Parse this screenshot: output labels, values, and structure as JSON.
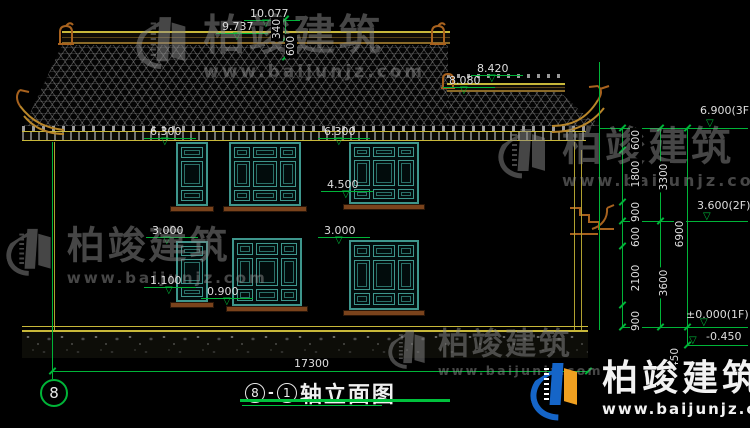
{
  "title_block": {
    "axis_left_bubble": "8",
    "circle_a": "8",
    "dash": "-",
    "circle_b": "1",
    "name": "轴立面图",
    "overall_dim": "17300"
  },
  "icons": {
    "level_triangle": "▽"
  },
  "levels": [
    {
      "t": "10.077",
      "x": 250,
      "y": 8,
      "lx": 244,
      "lw": 56,
      "tx": 262
    },
    {
      "t": "9.737",
      "x": 222,
      "y": 21,
      "lx": 216,
      "lw": 52,
      "tx": 233
    },
    {
      "t": "8.420",
      "x": 477,
      "y": 63,
      "lx": 471,
      "lw": 52,
      "tx": 488
    },
    {
      "t": "8.080",
      "x": 449,
      "y": 75,
      "lx": 443,
      "lw": 52,
      "tx": 460
    },
    {
      "t": "6.300",
      "x": 150,
      "y": 126,
      "lx": 144,
      "lw": 52,
      "tx": 161
    },
    {
      "t": "6.300",
      "x": 324,
      "y": 126,
      "lx": 318,
      "lw": 52,
      "tx": 335
    },
    {
      "t": "4.500",
      "x": 327,
      "y": 179,
      "lx": 321,
      "lw": 52,
      "tx": 342
    },
    {
      "t": "3.000",
      "x": 152,
      "y": 225,
      "lx": 146,
      "lw": 52,
      "tx": 163
    },
    {
      "t": "3.000",
      "x": 324,
      "y": 225,
      "lx": 318,
      "lw": 52,
      "tx": 335
    },
    {
      "t": "1.100",
      "x": 150,
      "y": 275,
      "lx": 144,
      "lw": 52,
      "tx": 165
    },
    {
      "t": "0.900",
      "x": 207,
      "y": 286,
      "lx": 201,
      "lw": 52,
      "tx": 223
    }
  ],
  "top_small_dims": [
    {
      "t": "340",
      "cx": 277,
      "cy": 29
    },
    {
      "t": "600",
      "cx": 291,
      "cy": 46
    }
  ],
  "right_stack": {
    "labels": [
      {
        "t": "6.900(3F)",
        "x": 700,
        "y": 105,
        "ly": 128,
        "lx1": 600,
        "tx": 706
      },
      {
        "t": "3.600(2F)",
        "x": 697,
        "y": 200,
        "ly": 221,
        "lx1": 622,
        "tx": 703
      },
      {
        "t": "±0.000(1F)",
        "x": 686,
        "y": 309,
        "ly": 327,
        "lx1": 622,
        "tx": 700
      },
      {
        "t": "-0.450",
        "x": 706,
        "y": 331,
        "ly": 345,
        "lx1": 687,
        "tx": 689
      }
    ],
    "texts": [
      {
        "t": "600",
        "cx": 636,
        "cy": 140
      },
      {
        "t": "1800",
        "cx": 636,
        "cy": 174
      },
      {
        "t": "900",
        "cx": 636,
        "cy": 212
      },
      {
        "t": "600",
        "cx": 636,
        "cy": 237
      },
      {
        "t": "2100",
        "cx": 636,
        "cy": 278
      },
      {
        "t": "900",
        "cx": 636,
        "cy": 321
      },
      {
        "t": "3300",
        "cx": 664,
        "cy": 177
      },
      {
        "t": "3600",
        "cx": 664,
        "cy": 283
      },
      {
        "t": "6900",
        "cx": 680,
        "cy": 234
      },
      {
        "t": "450",
        "cx": 675,
        "cy": 358
      }
    ],
    "vlines": [
      {
        "x": 285,
        "y1": 19,
        "y2": 58
      },
      {
        "x": 599,
        "y1": 62,
        "y2": 330
      },
      {
        "x": 622,
        "y1": 128,
        "y2": 327
      },
      {
        "x": 660,
        "y1": 128,
        "y2": 327
      },
      {
        "x": 687,
        "y1": 128,
        "y2": 345
      }
    ],
    "ticks": [
      {
        "x": 285,
        "y": 19
      },
      {
        "x": 285,
        "y": 38
      },
      {
        "x": 285,
        "y": 57
      },
      {
        "x": 622,
        "y": 128
      },
      {
        "x": 622,
        "y": 150
      },
      {
        "x": 622,
        "y": 202
      },
      {
        "x": 622,
        "y": 221
      },
      {
        "x": 622,
        "y": 246
      },
      {
        "x": 622,
        "y": 305
      },
      {
        "x": 622,
        "y": 327
      },
      {
        "x": 660,
        "y": 128
      },
      {
        "x": 660,
        "y": 221
      },
      {
        "x": 660,
        "y": 327
      },
      {
        "x": 687,
        "y": 128
      },
      {
        "x": 687,
        "y": 327
      },
      {
        "x": 687,
        "y": 345
      },
      {
        "x": 52,
        "y": 371
      },
      {
        "x": 588,
        "y": 371
      }
    ]
  },
  "windows": [
    {
      "x": 176,
      "y": 142,
      "w": 32,
      "h": 64,
      "cols": 1
    },
    {
      "x": 229,
      "y": 142,
      "w": 72,
      "h": 64,
      "cols": 3
    },
    {
      "x": 349,
      "y": 142,
      "w": 70,
      "h": 62,
      "cols": 3
    },
    {
      "x": 176,
      "y": 241,
      "w": 32,
      "h": 61,
      "cols": 1
    },
    {
      "x": 232,
      "y": 238,
      "w": 70,
      "h": 68,
      "cols": 3
    },
    {
      "x": 349,
      "y": 240,
      "w": 70,
      "h": 70,
      "cols": 3
    }
  ],
  "watermark": {
    "brand": "柏竣建筑",
    "url": "www.baijunjz.com",
    "items": [
      {
        "x": 136,
        "y": 14,
        "scale": 1.05
      },
      {
        "x": 498,
        "y": 126,
        "scale": 1.0
      },
      {
        "x": 6,
        "y": 226,
        "scale": 0.95
      },
      {
        "x": 388,
        "y": 328,
        "scale": 0.78
      }
    ]
  },
  "corner_logo": {
    "brand": "柏竣建筑",
    "url": "www.baijunjz.com"
  },
  "colors": {
    "dim_green": "#00b438",
    "text_white": "#dedede",
    "roof_yellow": "#c8b83a",
    "wood_brown": "#a8621e",
    "window_teal": "#3e968c",
    "sill_brown": "#7a431c",
    "watermark_gray": "#8c8c8c",
    "logo_blue": "#1565c8",
    "logo_orange": "#f0a020"
  }
}
